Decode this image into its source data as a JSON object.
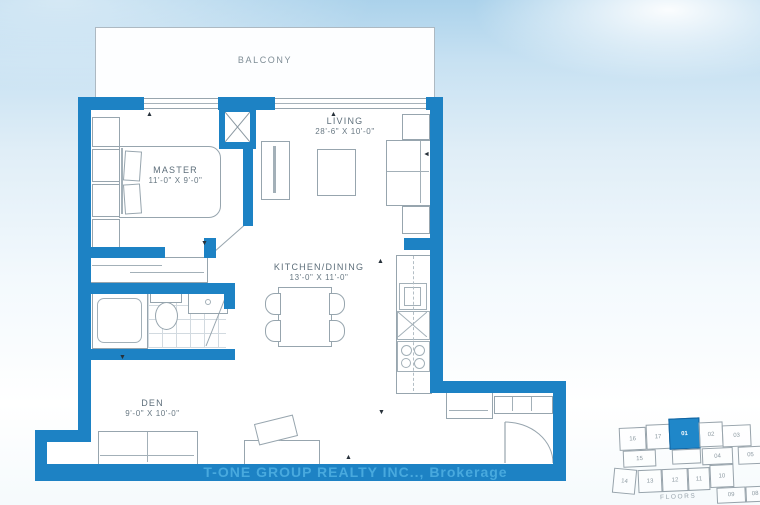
{
  "plan": {
    "balcony": {
      "label": "BALCONY"
    },
    "living": {
      "label": "LIVING",
      "dims": "28'-6\" X 10'-0\""
    },
    "master": {
      "label": "MASTER",
      "dims": "11'-0\" X 9'-0\""
    },
    "kitchen": {
      "label": "KITCHEN/DINING",
      "dims": "13'-0\" X 11'-0\""
    },
    "den": {
      "label": "DEN",
      "dims": "9'-0\" X 10'-0\""
    }
  },
  "watermark": {
    "text": "T-ONE GROUP REALTY INC.., Brokerage"
  },
  "keyplan": {
    "caption": "FLOORS",
    "highlighted_unit": "01",
    "units": [
      "16",
      "17",
      "01",
      "02",
      "03",
      "15",
      "04",
      "05",
      "14",
      "13",
      "12",
      "11",
      "10",
      "09",
      "08"
    ]
  },
  "colors": {
    "wall_blue": "#1d82c4",
    "watermark_text": "#48a9de",
    "keyplan_highlight": "#1f87c9",
    "sky_top": "#abd2eb",
    "line_gray": "#97a5ae"
  }
}
